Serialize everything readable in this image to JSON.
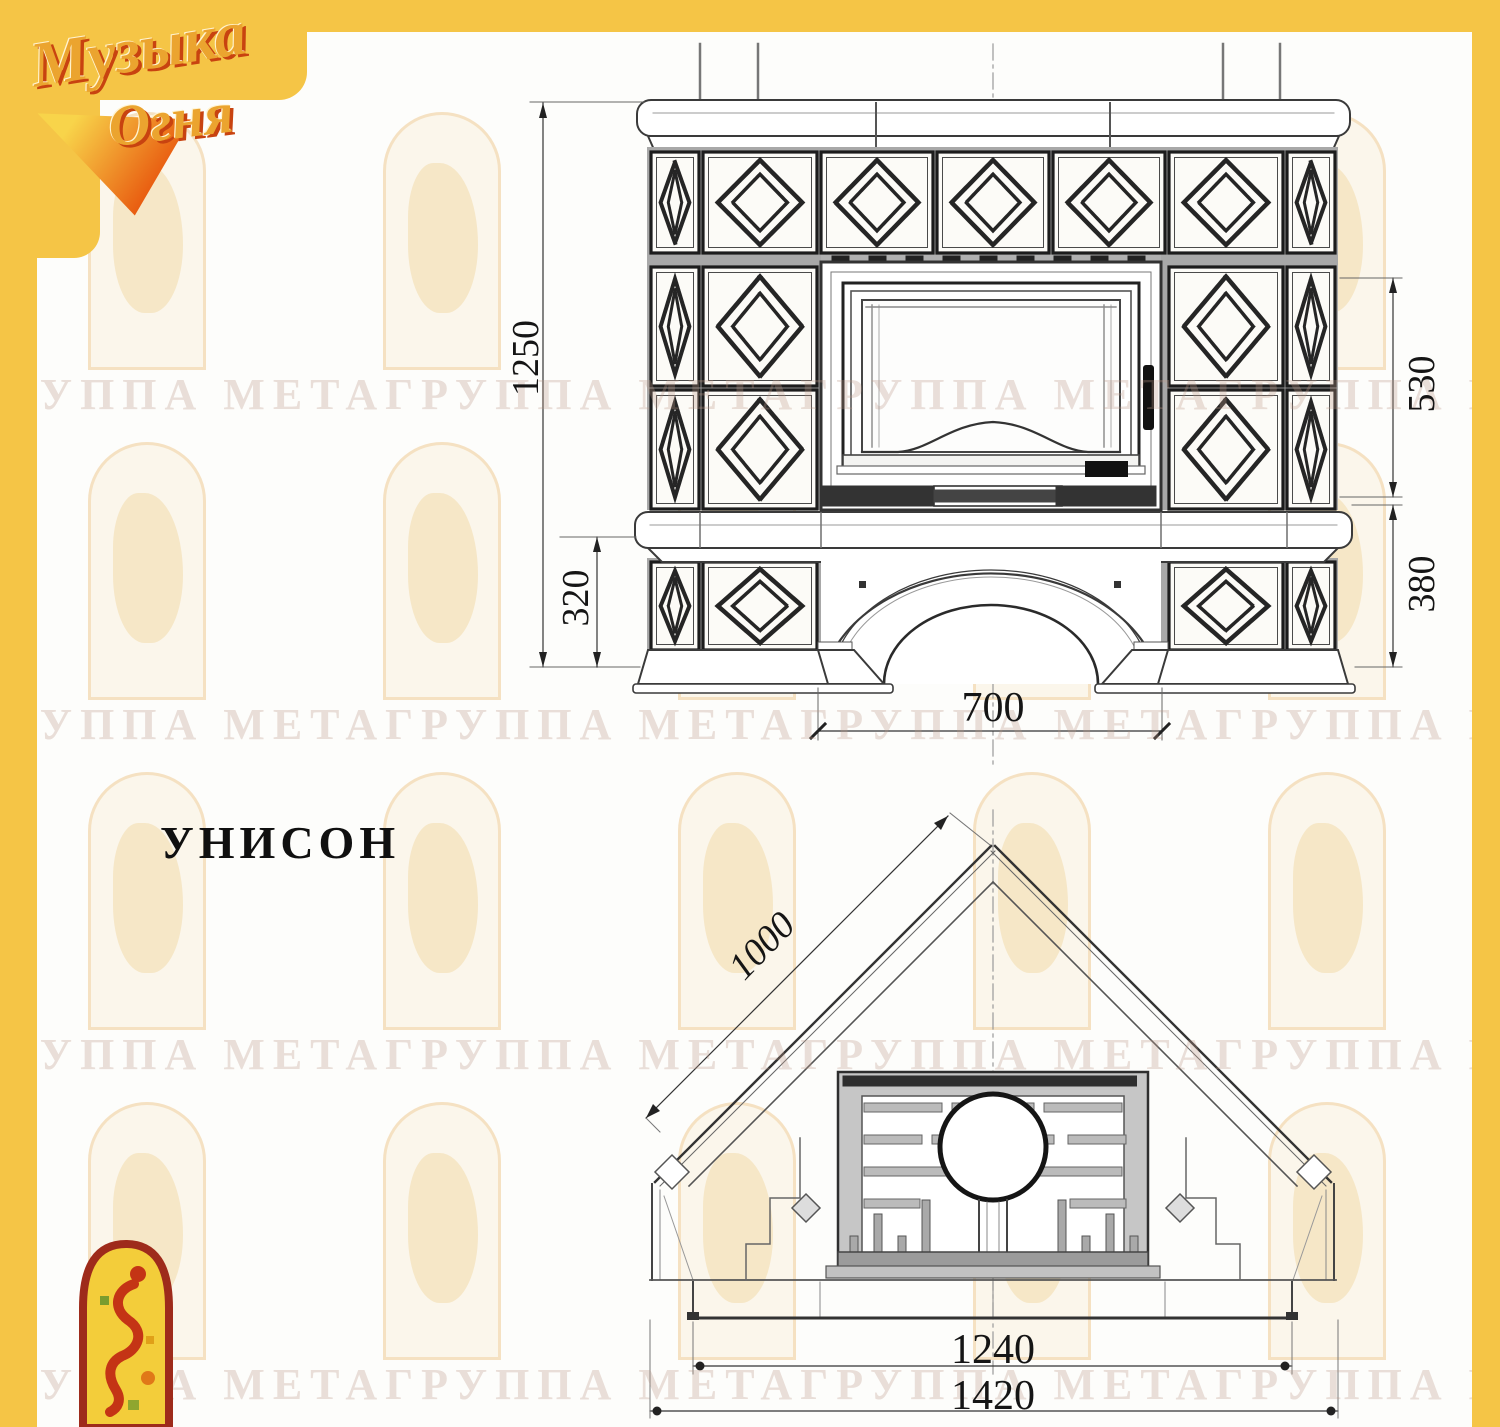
{
  "frame": {
    "color": "#F5C546"
  },
  "logo": {
    "word1": "Музыка",
    "word2": "Огня"
  },
  "model": {
    "title": "УНИСОН"
  },
  "watermark": {
    "text": "ГРУППА МЕТАГРУППА МЕТАГРУППА МЕТАГРУППА МЕТАГРУППА МЕТАГРУППА МЕТА"
  },
  "front_view": {
    "name": "front elevation of tiled fireplace",
    "dims": {
      "overall_height": "1250",
      "firebox_height": "530",
      "plinth_height_left": "320",
      "plinth_height_right": "380",
      "portal_width": "700"
    }
  },
  "plan_view": {
    "name": "corner plan view of fireplace",
    "dims": {
      "side_depth": "1000",
      "hearth_width": "1240",
      "overall_width": "1420"
    }
  },
  "colors": {
    "line_dark": "#1c1c1c",
    "line_mid": "#555555",
    "tile_fill": "#fcfbf7",
    "joint_gray": "#a8a8a8"
  }
}
